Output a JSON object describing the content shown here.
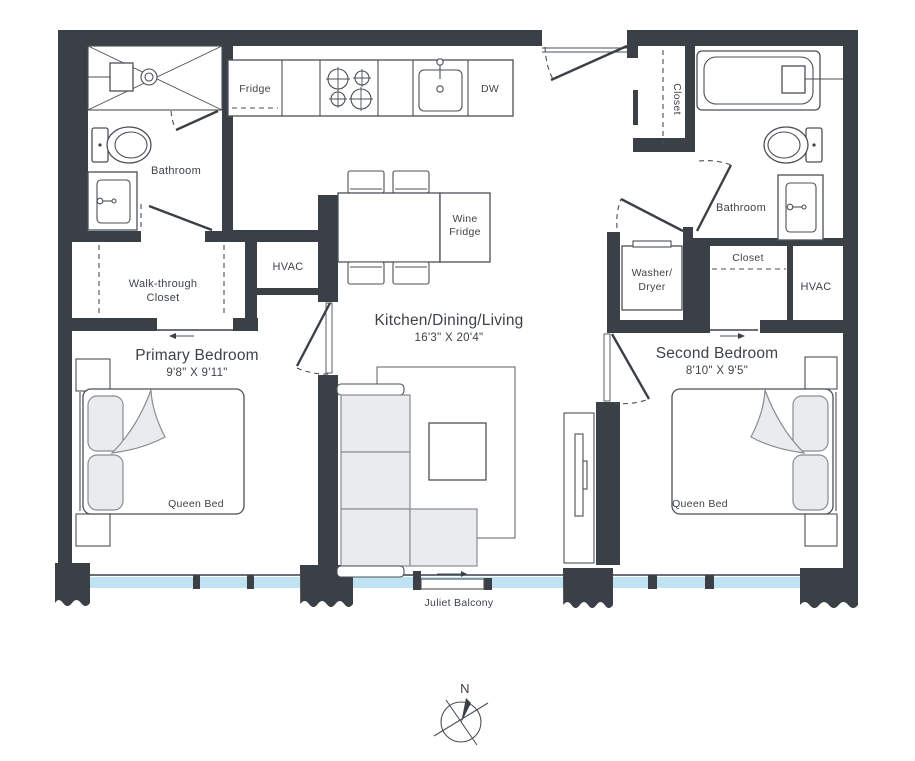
{
  "floorplan": {
    "rooms": {
      "kitchen_title": "Kitchen/Dining/Living",
      "kitchen_dims": "16'3\" X 20'4\"",
      "primary_title": "Primary Bedroom",
      "primary_dims": "9'8\" X 9'11\"",
      "primary_bed": "Queen Bed",
      "second_title": "Second Bedroom",
      "second_dims": "8'10\" X 9'5\"",
      "second_bed": "Queen Bed",
      "bathroom_left": "Bathroom",
      "bathroom_right": "Bathroom",
      "walk_through_line1": "Walk-through",
      "walk_through_line2": "Closet",
      "hvac_left": "HVAC",
      "hvac_right": "HVAC",
      "entry_closet": "Closet",
      "bedroom2_closet": "Closet",
      "washer_line1": "Washer/",
      "washer_line2": "Dryer",
      "balcony": "Juliet Balcony"
    },
    "appliances": {
      "fridge": "Fridge",
      "dishwasher": "DW",
      "wine_line1": "Wine",
      "wine_line2": "Fridge"
    },
    "compass": {
      "north": "N"
    },
    "colors": {
      "wall": "#3b4046",
      "window": "#bfe3f3",
      "furniture_fill": "#e9ebed",
      "line": "#4a5056"
    }
  }
}
